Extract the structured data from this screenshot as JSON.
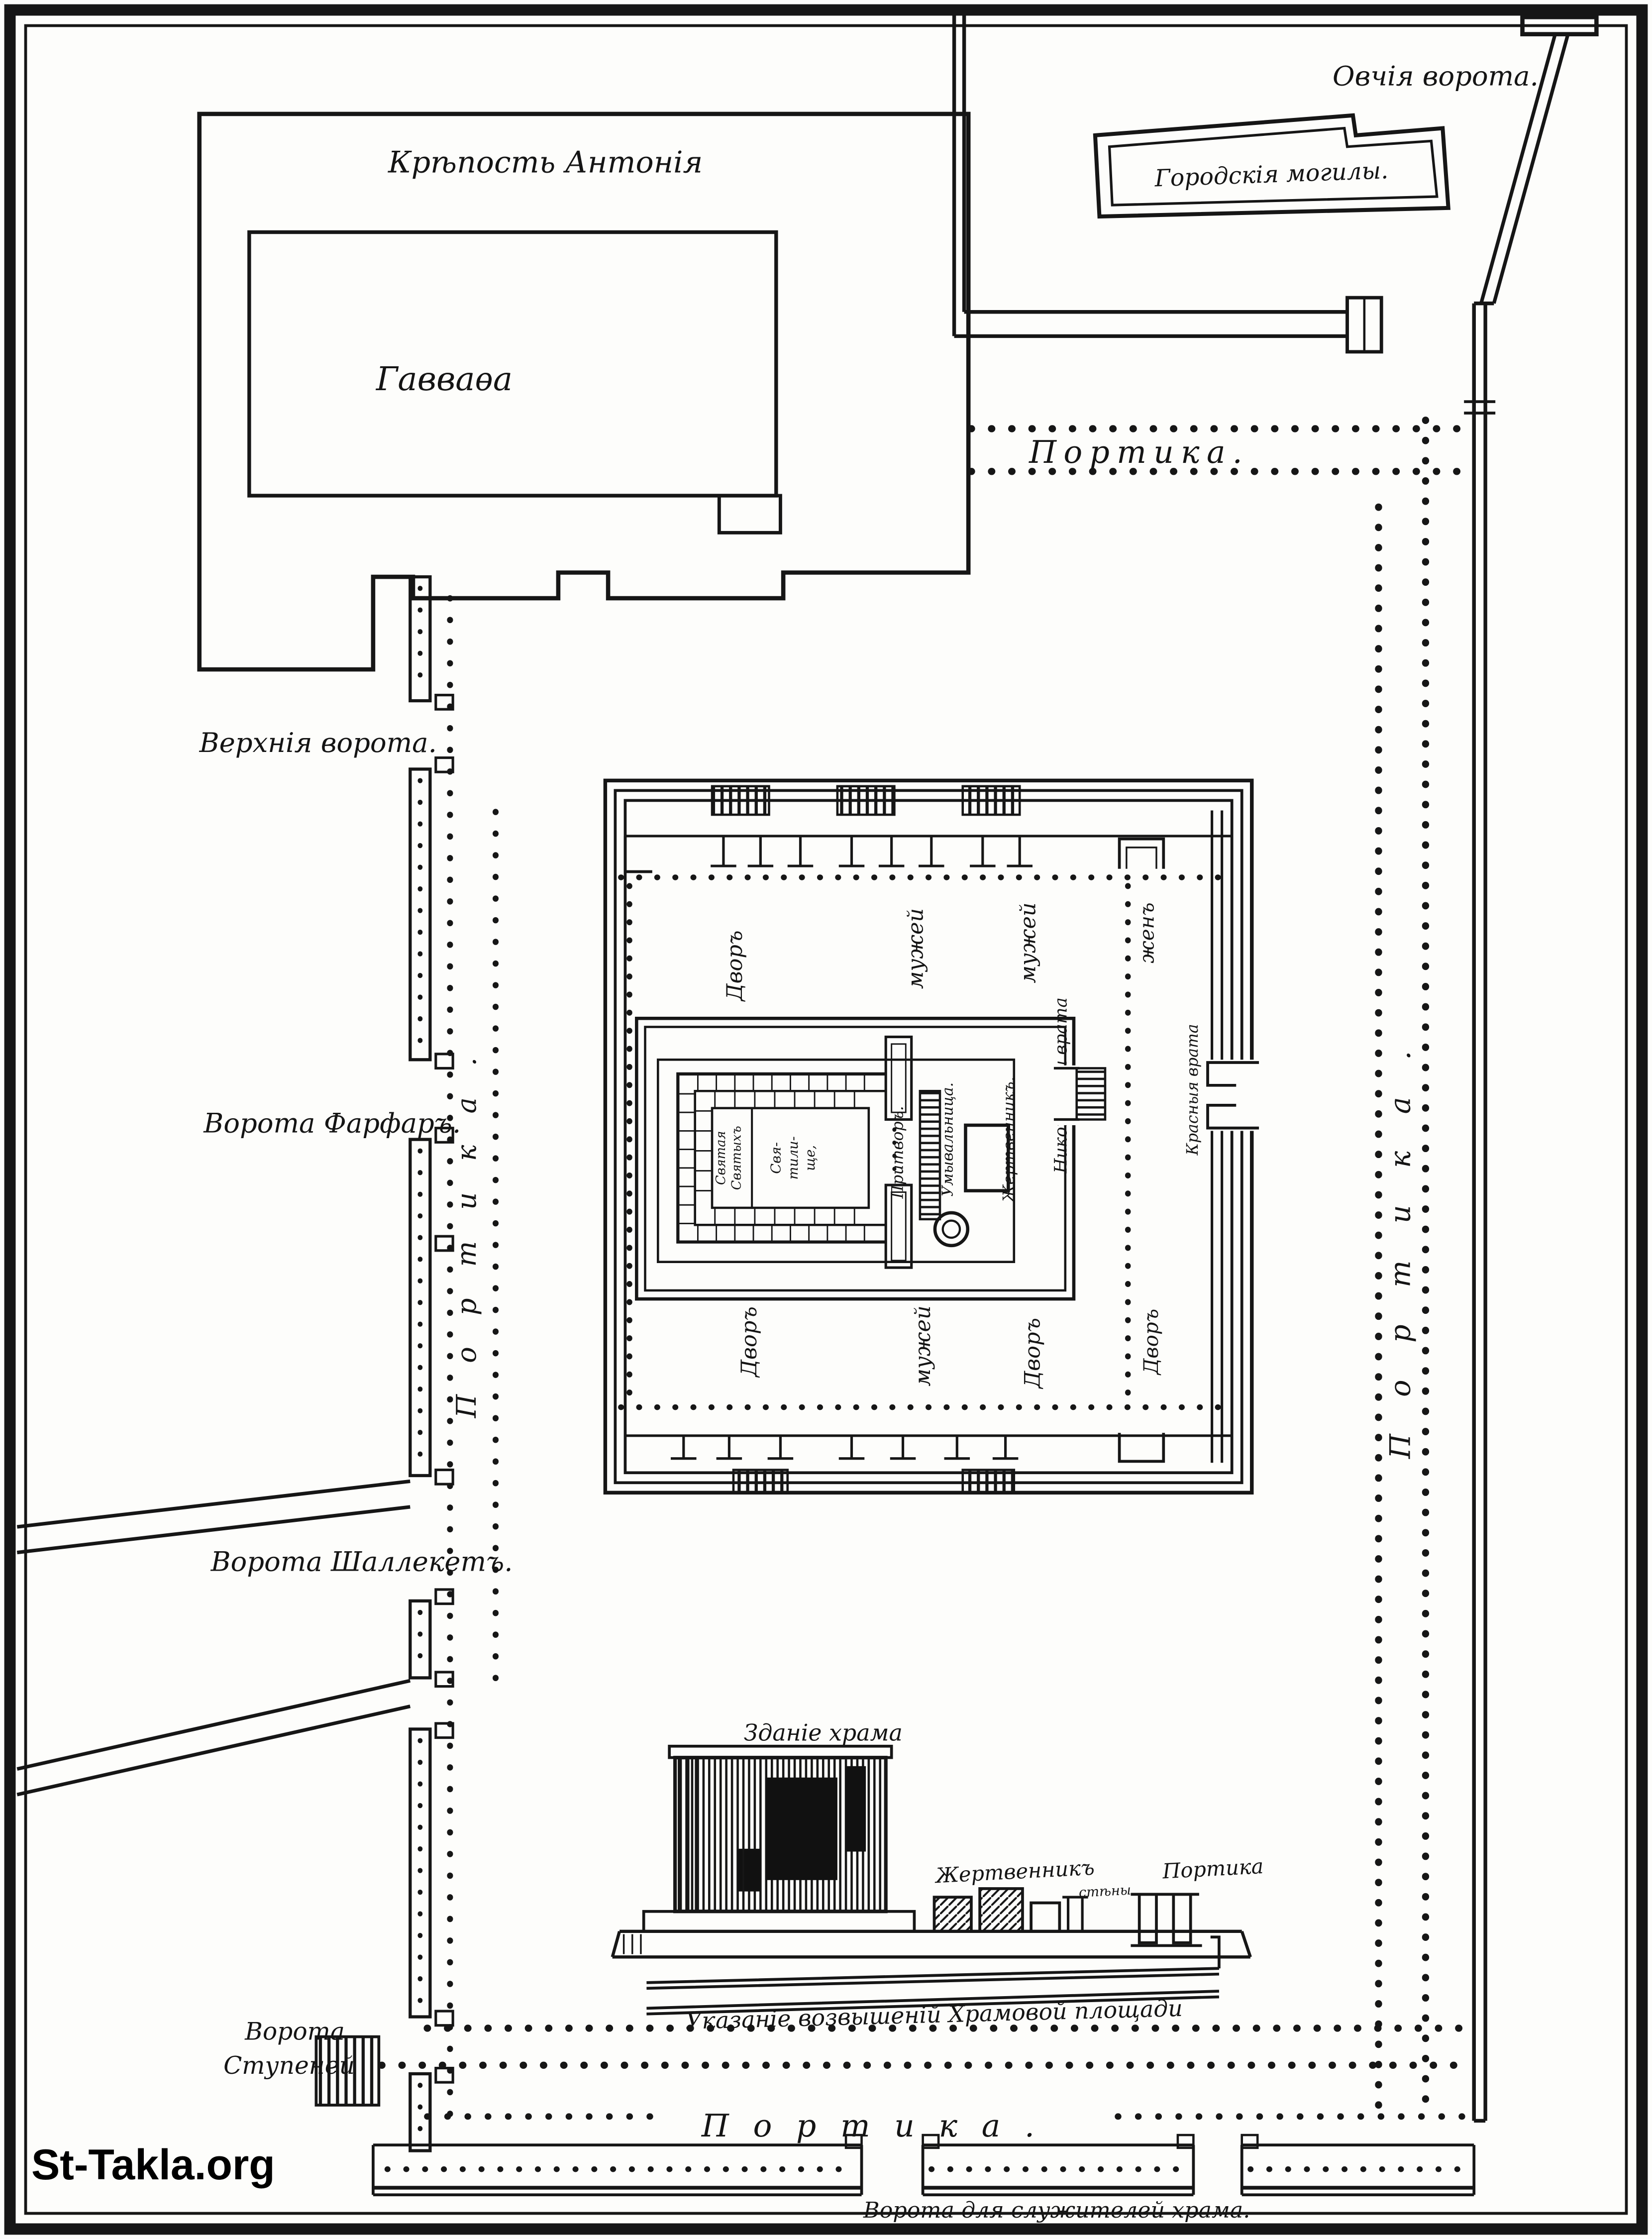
{
  "watermark": "St-Takla.org",
  "outer": {
    "sheep_gate": "Овчія ворота.",
    "city_graves": "Городскія могилы.",
    "antonia_fortress": "Крѣпость Антонія",
    "gabbatha": "Гавваѳа"
  },
  "porticoes": {
    "top": "Портика.",
    "right": "Портика.",
    "left": "Портика.",
    "bottom": "Портика."
  },
  "gates": {
    "upper": "Верхнія ворота.",
    "farfar": "Ворота Фарфаръ.",
    "shallecheth": "Ворота Шаллекетъ.",
    "steps_line1": "Ворота",
    "steps_line2": "Ступеней",
    "servants": "Ворота для служителей храма."
  },
  "inner_courts": {
    "top_court": "Дворъ",
    "top_men": "мужей",
    "top_men2": "мужей",
    "women_top": "женъ",
    "bottom_court": "Дворъ",
    "bottom_men": "мужей",
    "bottom_court2": "Дворъ",
    "women_bottom": "Дворъ",
    "nicanor_gate": "Никоноровы врата",
    "red_gate": "Красныя врата"
  },
  "temple_plan": {
    "holy_of_holies_line1": "Святая",
    "holy_of_holies_line2": "Святыхъ",
    "sanctuary_line1": "Свя-",
    "sanctuary_line2": "тили-",
    "sanctuary_line3": "ще,",
    "porch": "Притворъ.",
    "laver": "Умывальница.",
    "altar": "Жертвенникъ."
  },
  "elevation": {
    "temple_building": "Зданіе храма",
    "altar": "Жертвенникъ",
    "walls": "стѣны",
    "portico": "Портика",
    "caption": "Указаніе возвышеній Храмовой площади"
  }
}
